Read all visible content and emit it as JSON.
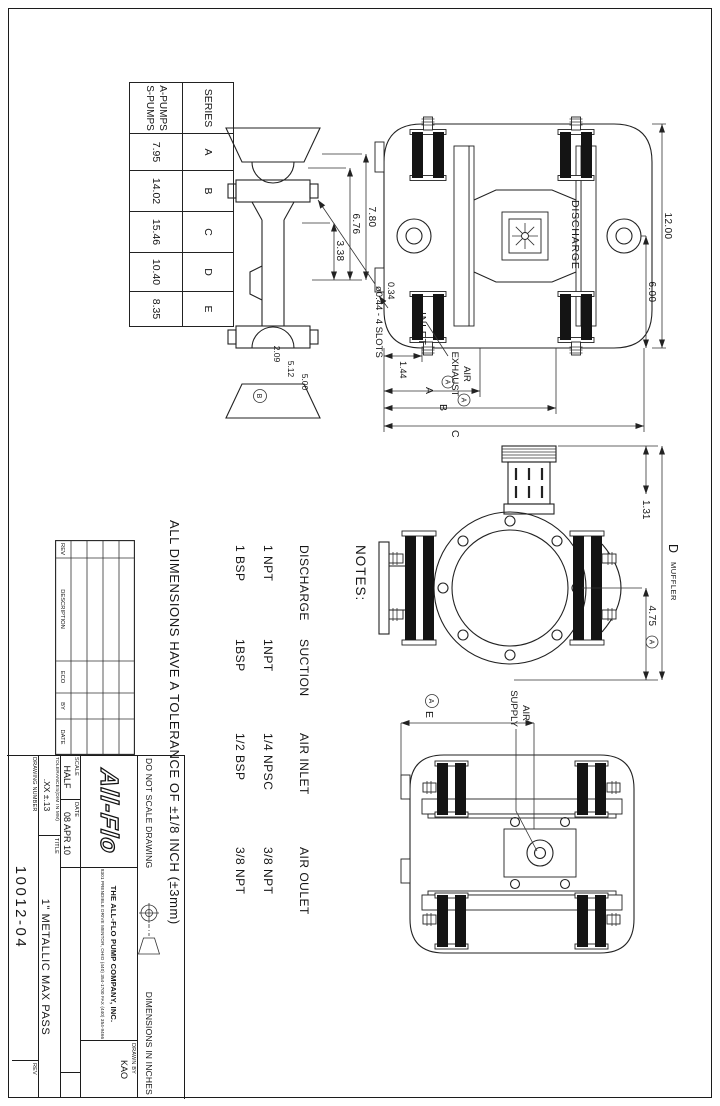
{
  "series_table": {
    "headers": [
      "SERIES",
      "A",
      "B",
      "C",
      "D",
      "E"
    ],
    "series_names": [
      "A-PUMPS",
      "S-PUMPS"
    ],
    "values": [
      "7.95",
      "14.02",
      "15.46",
      "10.40",
      "8.35"
    ]
  },
  "notes": {
    "title": "NOTES:",
    "columns": [
      {
        "header": "DISCHARGE",
        "v1": "1 NPT",
        "v2": "1 BSP"
      },
      {
        "header": "SUCTION",
        "v1": "1NPT",
        "v2": "1BSP"
      },
      {
        "header": "AIR INLET",
        "v1": "1/4 NPSC",
        "v2": "1/2 BSP"
      },
      {
        "header": "AIR OULET",
        "v1": "3/8 NPT",
        "v2": "3/8 NPT"
      }
    ]
  },
  "front_view": {
    "discharge": "DISCHARGE",
    "inlet": "INLET",
    "air_exhaust_line1": "AIR",
    "air_exhaust_line2": "EXHAUST",
    "dim_width": "12.00",
    "dim_half": "6.00",
    "dim_foot_offset": "0.34",
    "dim_foot": "1.44",
    "dim_a": "A",
    "dim_b": "B",
    "dim_c": "C",
    "ref_a": "A"
  },
  "profile_view": {
    "dim_780": "7.80",
    "dim_676": "6.76",
    "dim_338": "3.38",
    "dim_209": "2.09",
    "dim_512": "5.12",
    "dim_500": "5.00",
    "slots": "ø0.44 - 4 SLOTS",
    "ref_b": "B"
  },
  "side_view": {
    "dim_131": "1.31",
    "dim_d": "D",
    "muffler": "MUFFLER",
    "dim_475": "4.75",
    "ref_a": "A"
  },
  "rear_view": {
    "air_line1": "AIR",
    "air_line2": "SUPPLY",
    "dim_e": "E",
    "ref_a": "A"
  },
  "rev_table": {
    "headers": [
      "REV",
      "DESCRIPTION",
      "ECO",
      "BY",
      "DATE"
    ]
  },
  "title_block": {
    "tolerance_note": "ALL DIMENSIONS HAVE A TOLERANCE OF ±1/8 INCH (±3mm)",
    "do_not_scale": "DO NOT SCALE DRAWING",
    "dims_in_inches": "DIMENSIONS IN INCHES",
    "scale_label": "SCALE",
    "scale_value": "HALF",
    "date_label": "DATE",
    "date_value": "08 APR 10",
    "logo_text": "All-Flo",
    "company_line": "THE ALL-FLO PUMP COMPANY, INC.",
    "address_line": "8301 PRENDIBLE DRIVE    MENTOR, OHIO    (440) 354-1700    FAX (440) 354-9466",
    "drawn_by_label": "DRAWN BY",
    "drawn_by_value": "KAO",
    "tolerances_label": "TOLERANCES(DIM IN MM)",
    "tolerances_value": ".XX  ±.13",
    "title_label": "TITLE",
    "title_value": "1\" METALLIC MAX PASS",
    "drawing_number_label": "DRAWING NUMBER",
    "drawing_number": "10012-04",
    "rev_label": "REV"
  }
}
